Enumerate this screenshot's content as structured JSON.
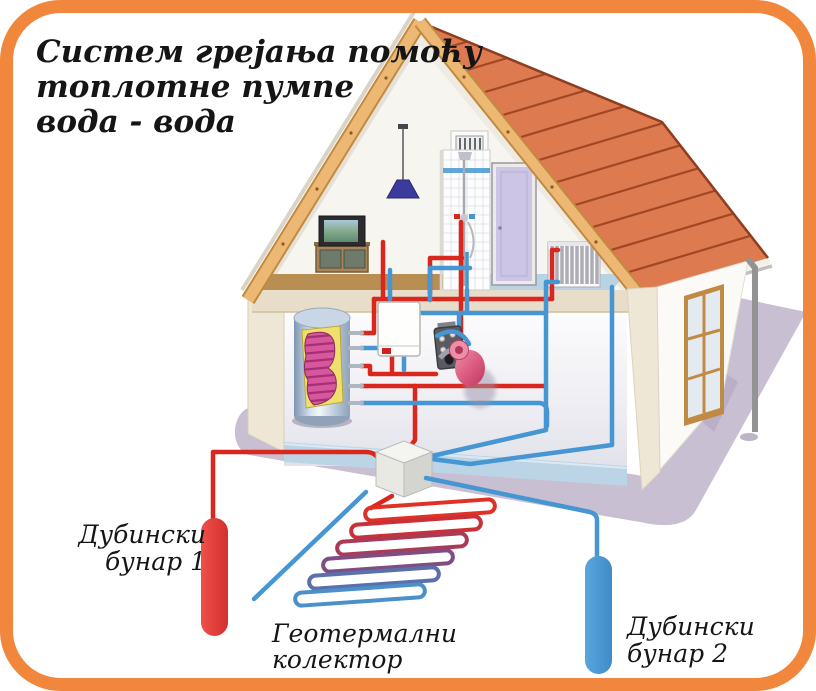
{
  "title": {
    "line1": "Систем грејања помоћу",
    "line2": "топлотне пумпе",
    "line3": "вода - вода"
  },
  "labels": {
    "well1_line1": "Дубински",
    "well1_line2": "бунар 1",
    "collector_line1": "Геотермални",
    "collector_line2": "колектор",
    "well2_line1": "Дубински",
    "well2_line2": "бунар 2"
  },
  "colors": {
    "frame": "#F0873C",
    "pipe_hot": "#D9271E",
    "pipe_cold": "#4596D2",
    "well1": "#E53935",
    "well2": "#4A9AD4",
    "ground": "#C8BFD2",
    "roof": "#DD7A50",
    "wood_trim": "#ECB873",
    "wall": "#EFE7D6",
    "collector_loops": [
      "#E03127",
      "#C93038",
      "#A93B58",
      "#7E4E82",
      "#5B6FAA",
      "#4B8FCB"
    ]
  }
}
